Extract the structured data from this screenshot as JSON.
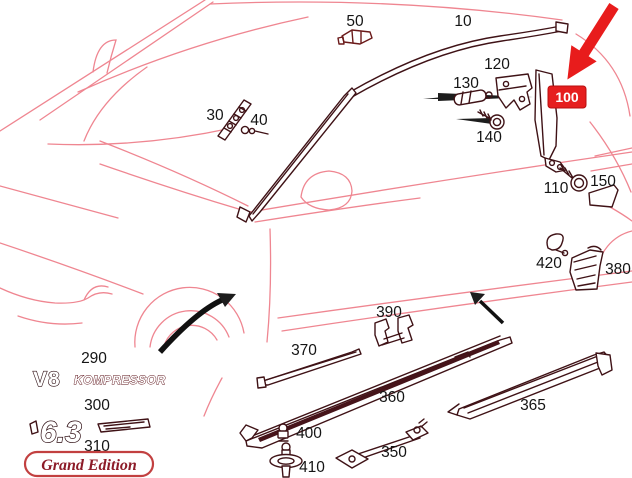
{
  "diagram": {
    "description": "Exploded parts diagram of coupe body side trim mouldings",
    "colors": {
      "car_outline": "#ef8691",
      "part_ink": "#3f1216",
      "highlight_red": "#e61e1e",
      "label_ink": "#151515",
      "badge_red": "#8c1b28"
    },
    "highlight": {
      "label": "100"
    },
    "part_labels": [
      {
        "text": "10",
        "x": 463,
        "y": 26
      },
      {
        "text": "50",
        "x": 355,
        "y": 26
      },
      {
        "text": "30",
        "x": 215,
        "y": 120
      },
      {
        "text": "40",
        "x": 259,
        "y": 125
      },
      {
        "text": "120",
        "x": 497,
        "y": 69
      },
      {
        "text": "130",
        "x": 466,
        "y": 88
      },
      {
        "text": "140",
        "x": 489,
        "y": 142
      },
      {
        "text": "110",
        "x": 556,
        "y": 193
      },
      {
        "text": "150",
        "x": 603,
        "y": 186
      },
      {
        "text": "420",
        "x": 549,
        "y": 268
      },
      {
        "text": "380",
        "x": 618,
        "y": 274
      },
      {
        "text": "290",
        "x": 94,
        "y": 363
      },
      {
        "text": "300",
        "x": 97,
        "y": 410
      },
      {
        "text": "310",
        "x": 97,
        "y": 451
      },
      {
        "text": "370",
        "x": 304,
        "y": 355
      },
      {
        "text": "390",
        "x": 389,
        "y": 317
      },
      {
        "text": "360",
        "x": 392,
        "y": 402
      },
      {
        "text": "365",
        "x": 533,
        "y": 410
      },
      {
        "text": "400",
        "x": 309,
        "y": 438
      },
      {
        "text": "410",
        "x": 312,
        "y": 472
      },
      {
        "text": "350",
        "x": 394,
        "y": 457
      }
    ],
    "badges": {
      "v8": "V8",
      "kompressor": "KOMPRESSOR",
      "six_three": "6.3",
      "grand_edition": "Grand Edition"
    }
  }
}
